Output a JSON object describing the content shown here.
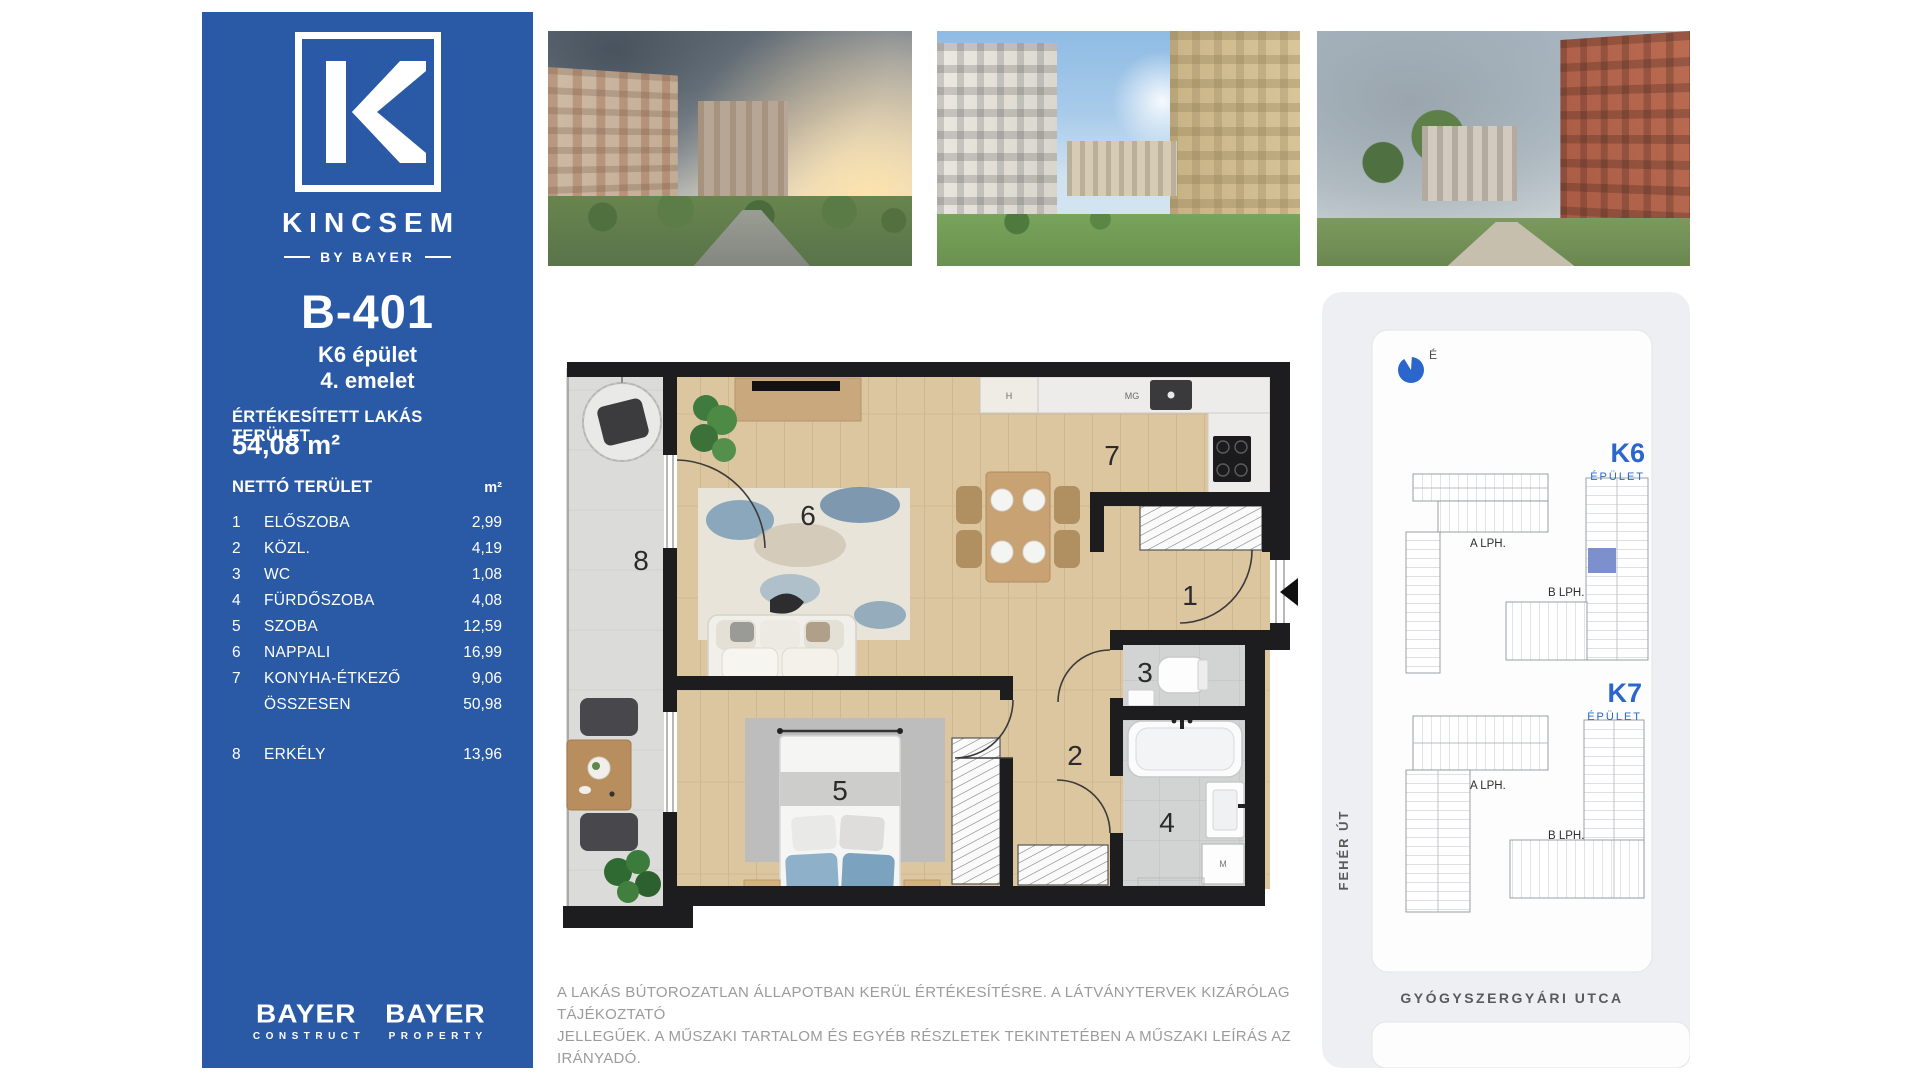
{
  "colors": {
    "sidebar_blue": "#2a5aa6",
    "map_label_blue": "#2b66cc",
    "unit_highlight_blue": "#7b90cc",
    "wall_black": "#1d1d1f",
    "wood_floor": "#dcc6a0",
    "tile_gray": "#d3d4d4",
    "balcony_concrete": "#dbdbd9",
    "disclaimer_gray": "#9b9b9b"
  },
  "sidebar": {
    "brand": "KINCSEM",
    "byline": "BY BAYER",
    "unit": {
      "id": "B-401",
      "building": "K6 épület",
      "floor": "4. emelet"
    },
    "area": {
      "label": "ÉRTÉKESÍTETT LAKÁS TERÜLET",
      "value": "54,08 m²"
    },
    "table": {
      "header_label": "NETTÓ TERÜLET",
      "header_unit": "m²",
      "rows": [
        {
          "num": "1",
          "name": "ELŐSZOBA",
          "value": "2,99"
        },
        {
          "num": "2",
          "name": "KÖZL.",
          "value": "4,19"
        },
        {
          "num": "3",
          "name": "WC",
          "value": "1,08"
        },
        {
          "num": "4",
          "name": "FÜRDŐSZOBA",
          "value": "4,08"
        },
        {
          "num": "5",
          "name": "SZOBA",
          "value": "12,59"
        },
        {
          "num": "6",
          "name": "NAPPALI",
          "value": "16,99"
        },
        {
          "num": "7",
          "name": "KONYHA-ÉTKEZŐ",
          "value": "9,06"
        },
        {
          "num": "",
          "name": "ÖSSZESEN",
          "value": "50,98"
        },
        {
          "num": "8",
          "name": "ERKÉLY",
          "value": "13,96"
        }
      ]
    },
    "footer": {
      "brand1": {
        "name": "BAYER",
        "division": "CONSTRUCT"
      },
      "brand2": {
        "name": "BAYER",
        "division": "PROPERTY"
      }
    }
  },
  "floorplan": {
    "rooms": {
      "n1": "1",
      "n2": "2",
      "n3": "3",
      "n4": "4",
      "n5": "5",
      "n6": "6",
      "n7": "7",
      "n8": "8"
    },
    "labels": {
      "hood": "H",
      "mg": "MG",
      "washer": "M"
    }
  },
  "map": {
    "compass": "É",
    "k6": {
      "code": "K6",
      "label": "ÉPÜLET",
      "stair_a": "A LPH.",
      "stair_b": "B LPH."
    },
    "k7": {
      "code": "K7",
      "label": "ÉPÜLET",
      "stair_a": "A LPH.",
      "stair_b": "B LPH."
    },
    "street_left": "FEHÉR ÚT",
    "street_bottom": "GYÓGYSZERGYÁRI UTCA"
  },
  "disclaimer": {
    "line1": "A LAKÁS BÚTOROZATLAN ÁLLAPOTBAN KERÜL ÉRTÉKESÍTÉSRE. A LÁTVÁNYTERVEK KIZÁRÓLAG TÁJÉKOZTATÓ",
    "line2": "JELLEGŰEK. A MŰSZAKI TARTALOM ÉS EGYÉB RÉSZLETEK TEKINTETÉBEN A MŰSZAKI LEÍRÁS AZ IRÁNYADÓ."
  }
}
